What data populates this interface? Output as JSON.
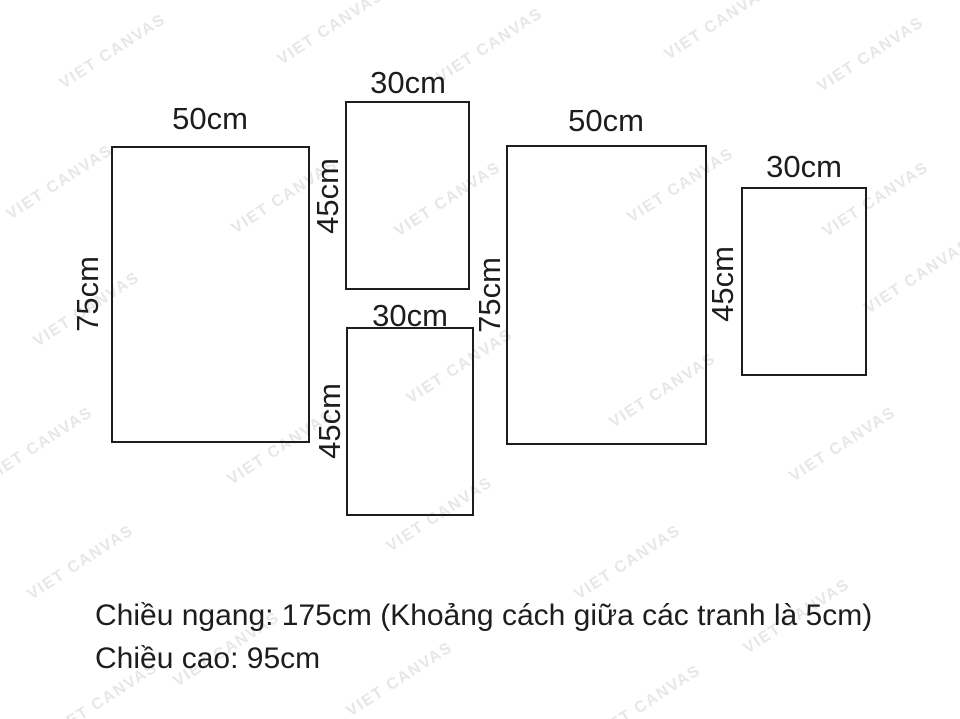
{
  "diagram": {
    "title": "canvas-set-dimension-diagram",
    "frames": [
      {
        "name": "left",
        "width_label": "50cm",
        "height_label": "75cm"
      },
      {
        "name": "top-middle",
        "width_label": "30cm",
        "height_label": "45cm"
      },
      {
        "name": "bottom-middle",
        "width_label": "30cm",
        "height_label": "45cm"
      },
      {
        "name": "right",
        "width_label": "50cm",
        "height_label": "75cm"
      },
      {
        "name": "far-right",
        "width_label": "30cm",
        "height_label": "45cm"
      }
    ],
    "caption": {
      "line1": "Chiều ngang: 175cm (Khoảng cách giữa các tranh là 5cm)",
      "line2": "Chiều cao: 95cm"
    },
    "watermark": {
      "text": "VIET CANVAS",
      "color": "#e7e7e7"
    },
    "colors": {
      "ink": "#1d1d1b",
      "background": "#ffffff"
    }
  }
}
